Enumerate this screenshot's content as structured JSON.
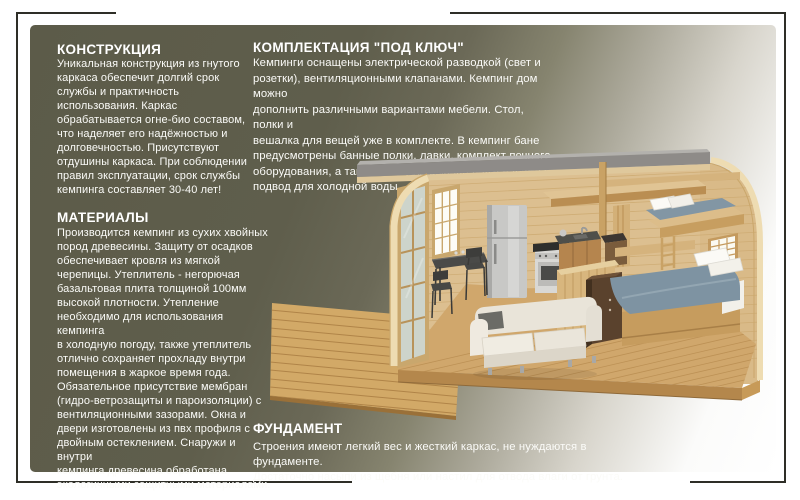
{
  "page": {
    "background": "#ffffff",
    "panel_dark_color": "#5c5b49",
    "crop_mark_color": "#2e2e27",
    "text_color": "#ffffff"
  },
  "sections": {
    "construction": {
      "heading": "КОНСТРУКЦИЯ",
      "body": "Уникальная конструкция из гнутого\nкаркаса обеспечит долгий срок\nслужбы и практичность\nиспользования. Каркас\nобрабатывается огне-био составом,\nчто наделяет его надёжностью и\nдолговечностью. Присутствуют\nотдушины каркаса. При соблюдении\nправил эксплуатации, срок службы\nкемпинга составляет 30-40 лет!"
    },
    "materials": {
      "heading": "МАТЕРИАЛЫ",
      "body": "Производится кемпинг из сухих хвойных\nпород древесины. Защиту от осадков\nобеспечивает кровля из мягкой\nчерепицы. Утеплитель - негорючая\nбазальтовая плита толщиной 100мм\nвысокой плотности. Утепление\nнеобходимо для использования кемпинга\nв холодную погоду, также утеплитель\nотлично сохраняет прохладу внутри\nпомещения в жаркое время года.\nОбязательное присутствие мембран\n(гидро-ветрозащиты и пароизоляции) с\nвентиляционными зазорами. Окна и\nдвери изготовлены из пвх профиля с\nдвойным остеклением. Снаружи и внутри\nкемпинга древесина обработана\nэкологичными защитными материалами."
    },
    "equipment": {
      "heading": "КОМПЛЕКТАЦИЯ \"ПОД КЛЮЧ\"",
      "body": "Кемпинги оснащены электрической разводкой (свет и\nрозетки), вентиляционными клапанами. Кемпинг дом можно\nдополнить различными вариантами мебели. Стол, полки и\nвешалка для вещей уже в комплекте. В кемпинг бане\nпредусмотрены банные полки, лавки, комплект печного\nоборудования, а также слив для вывода воды наружу и\nподвод для холодной воды."
    },
    "foundation": {
      "heading": "ФУНДАМЕНТ",
      "body": "Строения имеют легкий вес и жесткий каркас, не нуждаются в фундаменте.\nДостаточно насыпи из щебня или настил для отвода влаги от грунта."
    }
  },
  "illustration": {
    "name": "camping-pod-cutaway-render",
    "palette": {
      "wood_light": "#ddbf8e",
      "wood_mid": "#cfa76b",
      "wood_dark": "#b08448",
      "cut_edge": "#eedcb2",
      "roof_gray": "#8e8b88",
      "glass_bright": "#fcfbf4",
      "bedding_blue": "#7e93a2",
      "sofa_cream": "#e9e4d9",
      "wardrobe_brown": "#5a422d",
      "counter_dark": "#4f4f4a"
    }
  }
}
